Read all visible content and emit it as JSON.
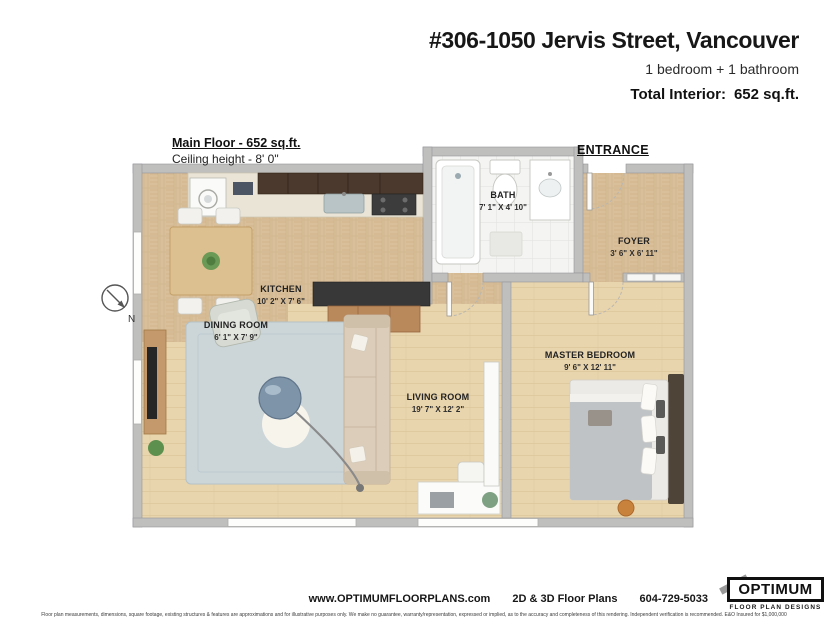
{
  "header": {
    "title": "#306-1050 Jervis Street, Vancouver",
    "subtitle": "1 bedroom + 1 bathroom",
    "total_interior_label": "Total Interior:",
    "total_interior_value": "652 sq.ft."
  },
  "plan": {
    "floor_label": "Main Floor - 652 sq.ft.",
    "ceiling_label": "Ceiling height - 8' 0\"",
    "entrance_label": "ENTRANCE",
    "compass_label": "N",
    "rooms": [
      {
        "name": "BATH",
        "dims": "7' 1\" X 4' 10\""
      },
      {
        "name": "FOYER",
        "dims": "3' 6\" X 6' 11\""
      },
      {
        "name": "KITCHEN",
        "dims": "10' 2\" X 7' 6\""
      },
      {
        "name": "DINING ROOM",
        "dims": "6' 1\" X 7' 9\""
      },
      {
        "name": "LIVING ROOM",
        "dims": "19' 7\" X 12' 2\""
      },
      {
        "name": "MASTER BEDROOM",
        "dims": "9' 6\" X 12' 11\""
      }
    ]
  },
  "footer": {
    "website": "www.OPTIMUMFLOORPLANS.com",
    "services": "2D & 3D Floor Plans",
    "phone": "604-729-5033",
    "logo_title": "OPTIMUM",
    "logo_subtitle": "FLOOR PLAN DESIGNS",
    "disclaimer": "Floor plan measurements, dimensions, square footage, existing structures & features are approximations and for illustrative purposes only. We make no guarantee, warranty/representation, expressed or implied, as to the accuracy and completeness of this rendering. Independent verification is recommended. E&O Insured for $1,000,000"
  },
  "colors": {
    "wall": "#bfbfbd",
    "wall_stroke": "#96969a",
    "parquet_floor": "#d9bf9a",
    "wood_floor": "#e8d4ad",
    "bath_tile": "#f4f4f2",
    "rug": "#ccd6d9",
    "dark_cabinet": "#4a392c",
    "island_counter": "#383838",
    "sideboard_wood": "#b9895c",
    "bed_duvet": "#bfc3c6",
    "stool_accent": "#c9823c",
    "text": "#1c1c1c"
  }
}
